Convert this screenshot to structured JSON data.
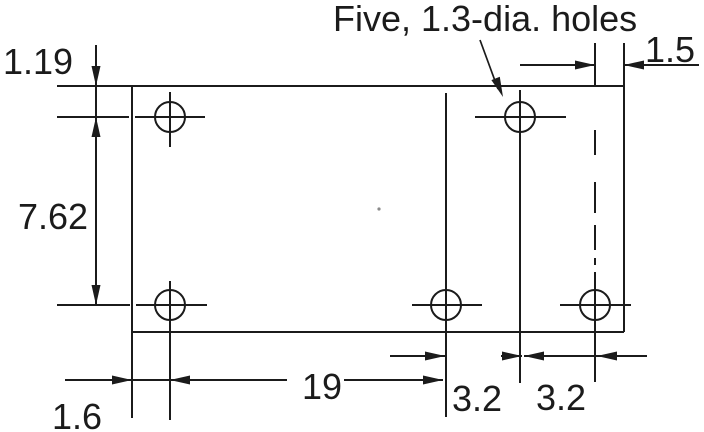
{
  "drawing": {
    "note_label": "Five, 1.3-dia. holes",
    "dims": {
      "top_edge_to_hole_row": "1.19",
      "hole_row_pitch": "7.62",
      "left_edge_to_hole": "1.6",
      "left_hole_to_center_hole": "19",
      "center_to_right_col": "3.2",
      "right_col_to_corner_hole": "3.2",
      "corner_hole_to_edge": "1.5"
    }
  }
}
